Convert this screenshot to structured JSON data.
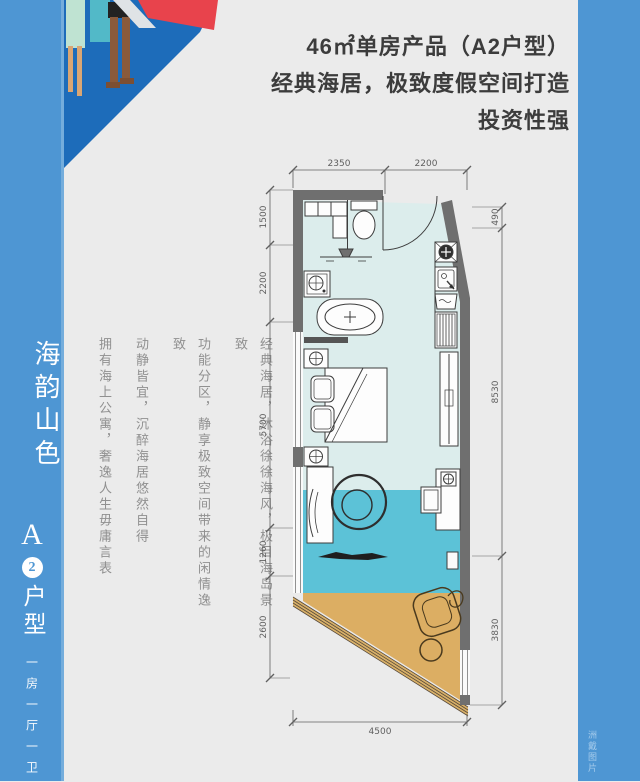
{
  "header": {
    "line1": "46㎡单房产品（A2户型）",
    "line2": "经典海居，极致度假空间打造",
    "line3": "投资性强"
  },
  "sidebar": {
    "title": "海韵山色",
    "unit_letter": "A",
    "unit_number": "2",
    "unit_label": "户型",
    "layout_label": "一房一厅一卫"
  },
  "description": {
    "columns": [
      "经典海居，沐浴徐徐海风，极目海岛景致",
      "功能分区，静享极致空间带来的闲情逸致",
      "动静皆宜，沉醉海居悠然自得",
      "拥有海上公寓，奢逸人生毋庸言表"
    ]
  },
  "floorplan": {
    "dimensions": {
      "top": [
        "2350",
        "2200"
      ],
      "left": [
        "1500",
        "2200",
        "5700",
        "1260",
        "2600"
      ],
      "right": [
        "490",
        "8530",
        "3830"
      ],
      "bottom": [
        "4500"
      ]
    },
    "colors": {
      "wall": "#6f6f6f",
      "floor": "#dcedec",
      "water": "#5cc2d7",
      "sand": "#dcae63",
      "accent_blue": "#4e96d3",
      "deep_blue": "#1d6cba",
      "red": "#e8434c"
    }
  },
  "watermark": "洲戴图片"
}
